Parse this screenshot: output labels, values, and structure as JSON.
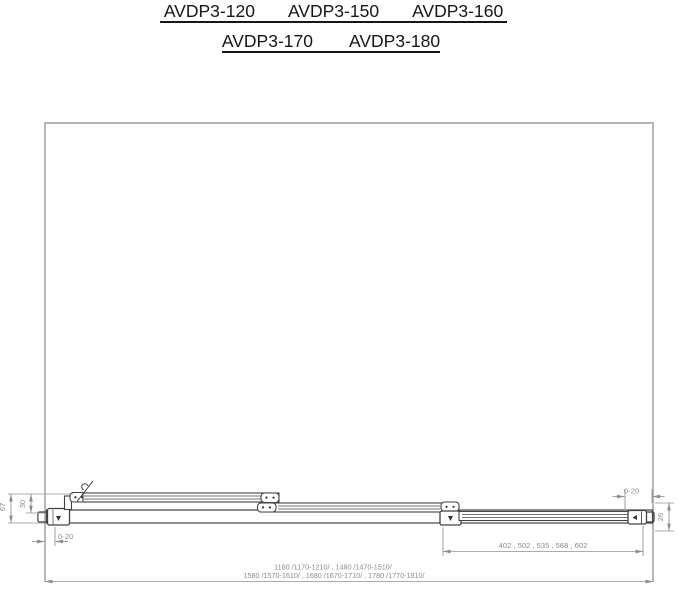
{
  "drawing": {
    "title_row1": [
      "AVDP3-120",
      "AVDP3-150",
      "AVDP3-160"
    ],
    "title_row2": [
      "AVDP3-170",
      "AVDP3-180"
    ],
    "dims": {
      "height_total": "67",
      "height_inner": "30",
      "wall_gap_left": "0-20",
      "wall_gap_right": "0-20",
      "end_depth": "26",
      "fixed_widths": "402 , 502 , 535 , 568 , 602",
      "overall_line1": "1180  /1170-1210/ , 1480  /1470-1510/",
      "overall_line2": "1580  /1570-1610/ , 1680  /1670-1710/ , 1780  /1770-1810/"
    },
    "colors": {
      "outline": "#9a9a9a",
      "profile": "#424242",
      "dimension": "#8f8f8f",
      "title": "#161616",
      "background": "#ffffff"
    }
  }
}
